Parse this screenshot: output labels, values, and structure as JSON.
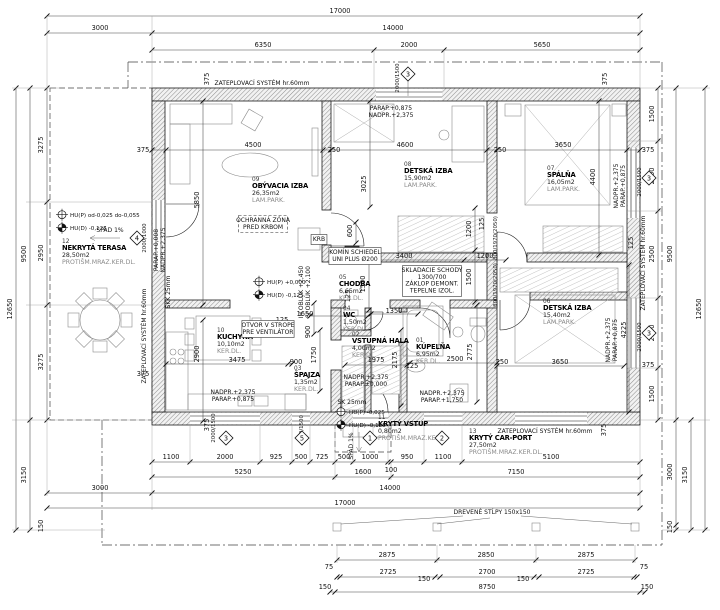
{
  "drawing": {
    "kind": "floor-plan",
    "colors": {
      "line": "#1a1a1a",
      "hatch": "#8a8a8a",
      "dim_text": "#111111",
      "muted": "#8a8a8a"
    }
  },
  "rooms": [
    {
      "num": "01",
      "name": "KÚPEĽŇA",
      "area": "6,95m2",
      "floor": "KER.DL.",
      "x": 416,
      "y": 342
    },
    {
      "num": "02",
      "name": "VSTUPNÁ HALA",
      "area": "4,00m2",
      "floor": "KER.DL.",
      "x": 352,
      "y": 336
    },
    {
      "num": "03",
      "name": "ŠPAJZA",
      "area": "1,35m2",
      "floor": "KER.DL.",
      "x": 294,
      "y": 370
    },
    {
      "num": "04",
      "name": "WC",
      "area": "1,50m2",
      "floor": "KER.DL.",
      "x": 343,
      "y": 310
    },
    {
      "num": "05",
      "name": "CHODBA",
      "area": "6,65m2",
      "floor": "KER.DL.",
      "x": 339,
      "y": 279
    },
    {
      "num": "06",
      "name": "DETSKÁ IZBA",
      "area": "15,40m2",
      "floor": "LAM.PARK.",
      "x": 543,
      "y": 303
    },
    {
      "num": "07",
      "name": "SPÁLŇA",
      "area": "16,05m2",
      "floor": "LAM.PARK.",
      "x": 547,
      "y": 170
    },
    {
      "num": "08",
      "name": "DETSKÁ IZBA",
      "area": "15,90m2",
      "floor": "LAM.PARK.",
      "x": 404,
      "y": 166
    },
    {
      "num": "09",
      "name": "OBÝVACIA IZBA",
      "area": "26,35m2",
      "floor": "LAM.PARK.",
      "x": 252,
      "y": 181
    },
    {
      "num": "10",
      "name": "KUCHYŇA",
      "area": "10,10m2",
      "floor": "KER.DL.",
      "x": 217,
      "y": 332
    },
    {
      "num": "11",
      "name": "KRYTÝ VSTUP",
      "area": "0,80m2",
      "floor": "PROTIŠM.MRAZ.KER.",
      "x": 378,
      "y": 419
    },
    {
      "num": "12",
      "name": "NEKRYTÁ TERASA",
      "area": "28,50m2",
      "floor": "PROTIŠM.MRAZ.KER.DL.",
      "x": 62,
      "y": 243
    },
    {
      "num": "13",
      "name": "KRYTÝ CAR-PORT",
      "area": "27,50m2",
      "floor": "PROTIŠM.MRAZ.KER.DL.",
      "x": 469,
      "y": 433
    }
  ],
  "dims": [
    {
      "t": "17000",
      "x": 340,
      "y": 13
    },
    {
      "t": "3000",
      "x": 100,
      "y": 30
    },
    {
      "t": "14000",
      "x": 393,
      "y": 30
    },
    {
      "t": "6350",
      "x": 263,
      "y": 47
    },
    {
      "t": "2000",
      "x": 409,
      "y": 47
    },
    {
      "t": "5650",
      "x": 542,
      "y": 47
    },
    {
      "t": "12650",
      "x": 12,
      "y": 309,
      "r": 1
    },
    {
      "t": "9500",
      "x": 26,
      "y": 254,
      "r": 1
    },
    {
      "t": "3275",
      "x": 43,
      "y": 145,
      "r": 1
    },
    {
      "t": "2950",
      "x": 43,
      "y": 253,
      "r": 1
    },
    {
      "t": "3275",
      "x": 43,
      "y": 362,
      "r": 1
    },
    {
      "t": "3150",
      "x": 26,
      "y": 475,
      "r": 1
    },
    {
      "t": "150",
      "x": 43,
      "y": 526,
      "r": 1
    },
    {
      "t": "3000",
      "x": 100,
      "y": 490
    },
    {
      "t": "1500",
      "x": 654,
      "y": 114,
      "r": 1
    },
    {
      "t": "2000",
      "x": 654,
      "y": 176,
      "r": 1
    },
    {
      "t": "2500",
      "x": 654,
      "y": 254,
      "r": 1
    },
    {
      "t": "2000",
      "x": 654,
      "y": 333,
      "r": 1
    },
    {
      "t": "1500",
      "x": 654,
      "y": 394,
      "r": 1
    },
    {
      "t": "9500",
      "x": 672,
      "y": 254,
      "r": 1
    },
    {
      "t": "3000",
      "x": 672,
      "y": 472,
      "r": 1
    },
    {
      "t": "150",
      "x": 672,
      "y": 527,
      "r": 1
    },
    {
      "t": "3150",
      "x": 687,
      "y": 475,
      "r": 1
    },
    {
      "t": "12650",
      "x": 701,
      "y": 309,
      "r": 1
    },
    {
      "t": "1100",
      "x": 171,
      "y": 459
    },
    {
      "t": "2000",
      "x": 225,
      "y": 459
    },
    {
      "t": "925",
      "x": 276,
      "y": 459
    },
    {
      "t": "500",
      "x": 301,
      "y": 459
    },
    {
      "t": "725",
      "x": 322,
      "y": 459
    },
    {
      "t": "500",
      "x": 344,
      "y": 459
    },
    {
      "t": "1000",
      "x": 370,
      "y": 459
    },
    {
      "t": "950",
      "x": 407,
      "y": 459
    },
    {
      "t": "1100",
      "x": 443,
      "y": 459
    },
    {
      "t": "5100",
      "x": 551,
      "y": 459
    },
    {
      "t": "100",
      "x": 391,
      "y": 472
    },
    {
      "t": "5250",
      "x": 243,
      "y": 474
    },
    {
      "t": "1600",
      "x": 363,
      "y": 474
    },
    {
      "t": "7150",
      "x": 516,
      "y": 474
    },
    {
      "t": "14000",
      "x": 390,
      "y": 490
    },
    {
      "t": "17000",
      "x": 345,
      "y": 505
    },
    {
      "t": "2875",
      "x": 387,
      "y": 557
    },
    {
      "t": "2850",
      "x": 486,
      "y": 557
    },
    {
      "t": "2875",
      "x": 586,
      "y": 557
    },
    {
      "t": "75",
      "x": 329,
      "y": 569
    },
    {
      "t": "75",
      "x": 644,
      "y": 569
    },
    {
      "t": "2725",
      "x": 388,
      "y": 574
    },
    {
      "t": "150",
      "x": 424,
      "y": 581
    },
    {
      "t": "2700",
      "x": 487,
      "y": 574
    },
    {
      "t": "150",
      "x": 523,
      "y": 581
    },
    {
      "t": "2725",
      "x": 586,
      "y": 574
    },
    {
      "t": "150",
      "x": 325,
      "y": 589
    },
    {
      "t": "8750",
      "x": 487,
      "y": 589
    },
    {
      "t": "150",
      "x": 647,
      "y": 589
    },
    {
      "t": "375",
      "x": 143,
      "y": 152
    },
    {
      "t": "375",
      "x": 209,
      "y": 79,
      "r": 1
    },
    {
      "t": "375",
      "x": 607,
      "y": 79,
      "r": 1
    },
    {
      "t": "375",
      "x": 648,
      "y": 152
    },
    {
      "t": "375",
      "x": 143,
      "y": 376
    },
    {
      "t": "375",
      "x": 209,
      "y": 425,
      "r": 1
    },
    {
      "t": "375",
      "x": 606,
      "y": 430,
      "r": 1
    },
    {
      "t": "375",
      "x": 648,
      "y": 367
    },
    {
      "t": "4500",
      "x": 253,
      "y": 147
    },
    {
      "t": "250",
      "x": 334,
      "y": 152
    },
    {
      "t": "4600",
      "x": 405,
      "y": 147
    },
    {
      "t": "250",
      "x": 500,
      "y": 152
    },
    {
      "t": "3650",
      "x": 563,
      "y": 147
    },
    {
      "t": "5850",
      "x": 199,
      "y": 200,
      "r": 1
    },
    {
      "t": "3025",
      "x": 366,
      "y": 184,
      "r": 1
    },
    {
      "t": "4400",
      "x": 595,
      "y": 177,
      "r": 1
    },
    {
      "t": "3400",
      "x": 404,
      "y": 258
    },
    {
      "t": "1200",
      "x": 485,
      "y": 258
    },
    {
      "t": "1200",
      "x": 471,
      "y": 229,
      "r": 1
    },
    {
      "t": "1500",
      "x": 471,
      "y": 277,
      "r": 1
    },
    {
      "t": "1500",
      "x": 365,
      "y": 284,
      "r": 1
    },
    {
      "t": "600",
      "x": 352,
      "y": 231,
      "r": 1
    },
    {
      "t": "125",
      "x": 484,
      "y": 224,
      "r": 1
    },
    {
      "t": "1650",
      "x": 305,
      "y": 316
    },
    {
      "t": "1350",
      "x": 394,
      "y": 313
    },
    {
      "t": "125",
      "x": 282,
      "y": 322
    },
    {
      "t": "900",
      "x": 310,
      "y": 332,
      "r": 1
    },
    {
      "t": "900",
      "x": 296,
      "y": 364
    },
    {
      "t": "1750",
      "x": 316,
      "y": 355,
      "r": 1
    },
    {
      "t": "2900",
      "x": 199,
      "y": 354,
      "r": 1
    },
    {
      "t": "3475",
      "x": 237,
      "y": 362
    },
    {
      "t": "1975",
      "x": 376,
      "y": 362
    },
    {
      "t": "2175",
      "x": 397,
      "y": 360,
      "r": 1
    },
    {
      "t": "2500",
      "x": 455,
      "y": 361
    },
    {
      "t": "2775",
      "x": 472,
      "y": 352,
      "r": 1
    },
    {
      "t": "3650",
      "x": 560,
      "y": 364
    },
    {
      "t": "4225",
      "x": 626,
      "y": 330,
      "r": 1
    },
    {
      "t": "250",
      "x": 502,
      "y": 364
    },
    {
      "t": "125",
      "x": 412,
      "y": 368
    },
    {
      "t": "125",
      "x": 350,
      "y": 296,
      "r": 1
    },
    {
      "t": "125",
      "x": 633,
      "y": 243,
      "r": 1
    }
  ],
  "window_specs": [
    {
      "t": "2000/1500",
      "x": 399,
      "y": 78,
      "r": 1
    },
    {
      "t": "2000/1000",
      "x": 146,
      "y": 238,
      "r": 1
    },
    {
      "t": "2000/1500",
      "x": 641,
      "y": 182,
      "r": 1
    },
    {
      "t": "2000/1500",
      "x": 641,
      "y": 337,
      "r": 1
    },
    {
      "t": "2000/1500",
      "x": 215,
      "y": 428,
      "r": 1
    },
    {
      "t": "500/1500",
      "x": 303,
      "y": 428,
      "r": 1
    },
    {
      "t": "800/1970(2050)",
      "x": 497,
      "y": 238,
      "r": 1
    },
    {
      "t": "800/1970(2050)",
      "x": 497,
      "y": 285,
      "r": 1
    }
  ],
  "markers": [
    {
      "n": "3",
      "x": 408,
      "y": 74
    },
    {
      "n": "4",
      "x": 137,
      "y": 238
    },
    {
      "n": "3",
      "x": 649,
      "y": 178
    },
    {
      "n": "3",
      "x": 649,
      "y": 333
    },
    {
      "n": "3",
      "x": 226,
      "y": 438
    },
    {
      "n": "5",
      "x": 302,
      "y": 438
    },
    {
      "n": "1",
      "x": 370,
      "y": 438
    },
    {
      "n": "2",
      "x": 442,
      "y": 438
    }
  ],
  "levels": [
    {
      "t": "HU(P) od-0,025 do-0,055",
      "x": 70,
      "y": 217,
      "k": "p"
    },
    {
      "t": "HU(D) -0,125",
      "x": 70,
      "y": 230,
      "k": "d"
    },
    {
      "t": "HU(P) +0,000",
      "x": 267,
      "y": 284,
      "k": "p"
    },
    {
      "t": "HU(D) -0,125",
      "x": 267,
      "y": 297,
      "k": "d"
    },
    {
      "t": "HU(P) -0,025",
      "x": 349,
      "y": 414,
      "k": "p"
    },
    {
      "t": "HU(D) -0,125",
      "x": 349,
      "y": 427,
      "k": "d"
    }
  ],
  "annotations": [
    {
      "lines": [
        "ZATEPLOVACÍ SYSTÉM hr.60mm"
      ],
      "x": 262,
      "y": 85
    },
    {
      "lines": [
        "ZATEPLOVACÍ SYSTÉM hr.60mm"
      ],
      "x": 545,
      "y": 433
    },
    {
      "lines": [
        "ZATEPLOVACÍ SYSTÉM hr.60mm"
      ],
      "x": 146,
      "y": 336,
      "r": 1
    },
    {
      "lines": [
        "ZATEPLOVACÍ SYSTÉM hr.60mm"
      ],
      "x": 645,
      "y": 263,
      "r": 1
    },
    {
      "lines": [
        "OCHRANNÁ ZÓNA",
        "PRED KRBOM"
      ],
      "x": 263,
      "y": 222,
      "box": "dashed"
    },
    {
      "lines": [
        "KRB"
      ],
      "x": 319,
      "y": 241,
      "box": "solid"
    },
    {
      "lines": [
        "KOMÍN SCHIEDEL",
        "UNI PLUS Ø200"
      ],
      "x": 355,
      "y": 254,
      "box": "solid"
    },
    {
      "lines": [
        "OTVOR V STROPE",
        "PRE VENTILÁTOR"
      ],
      "x": 268,
      "y": 327,
      "box": "solid"
    },
    {
      "lines": [
        "SKLADACIE SCHODY",
        "1300/700",
        "ZÁKLOP DEMONT.",
        "TEPELNE IZOL."
      ],
      "x": 432,
      "y": 272,
      "box": "solid"
    },
    {
      "lines": [
        "DREVENÉ STĹPY 150x150"
      ],
      "x": 492,
      "y": 514
    },
    {
      "lines": [
        "SPÁD 1%"
      ],
      "x": 110,
      "y": 232
    },
    {
      "lines": [
        "SPÁD 1%"
      ],
      "x": 353,
      "y": 446,
      "r": 1
    },
    {
      "lines": [
        "PARAP.+0,875",
        "NADPR.+2,375"
      ],
      "x": 391,
      "y": 110
    },
    {
      "lines": [
        "PARAP.+0,008",
        "NADPR.+2,375"
      ],
      "x": 158,
      "y": 250,
      "r": 1
    },
    {
      "lines": [
        "NADPR.+2,375",
        "PARAP.+0,875"
      ],
      "x": 618,
      "y": 186,
      "r": 1
    },
    {
      "lines": [
        "NADPR.+2,375",
        "PARAP.+0,875"
      ],
      "x": 233,
      "y": 394
    },
    {
      "lines": [
        "NADPR.+2,375",
        "PARAP.+1,750"
      ],
      "x": 442,
      "y": 395
    },
    {
      "lines": [
        "NADPR.+2,375",
        "PARAP.±0,000"
      ],
      "x": 366,
      "y": 379
    },
    {
      "lines": [
        "NADPR.+2,375",
        "PARAP.+0,875"
      ],
      "x": 610,
      "y": 340,
      "r": 1
    },
    {
      "lines": [
        "IH OBLÚK +2,450",
        "SI OBLÚK +2,100"
      ],
      "x": 303,
      "y": 292,
      "r": 1
    },
    {
      "lines": [
        "SKK 25mm"
      ],
      "x": 170,
      "y": 292,
      "r": 1
    },
    {
      "lines": [
        "SK 25mm"
      ],
      "x": 352,
      "y": 404
    }
  ]
}
